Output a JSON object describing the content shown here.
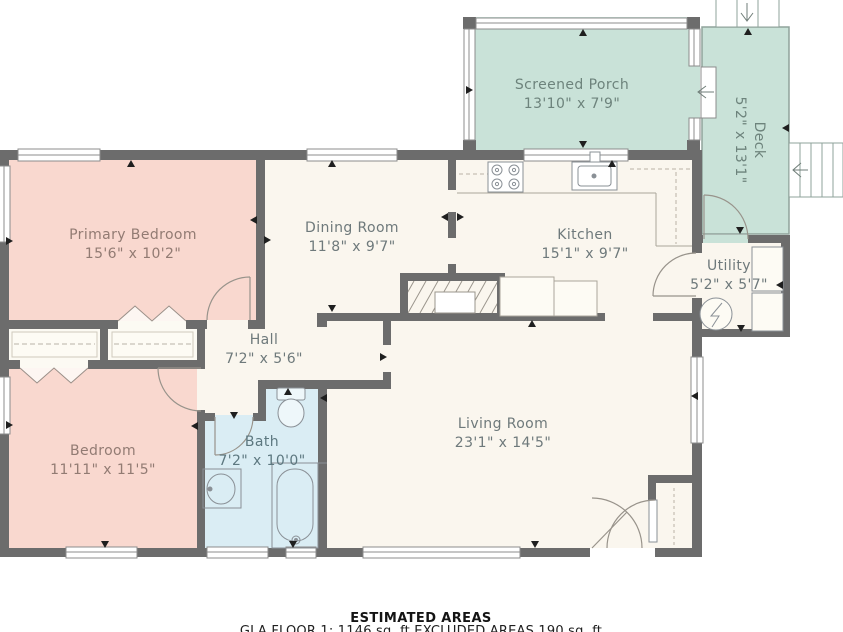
{
  "floorplan": {
    "rooms": {
      "screened_porch": {
        "name": "Screened Porch",
        "dims": "13'10\" x 7'9\""
      },
      "deck": {
        "name": "Deck",
        "dims": "5'2\" x 13'1\""
      },
      "primary_bedroom": {
        "name": "Primary Bedroom",
        "dims": "15'6\" x 10'2\""
      },
      "dining_room": {
        "name": "Dining Room",
        "dims": "11'8\" x 9'7\""
      },
      "kitchen": {
        "name": "Kitchen",
        "dims": "15'1\" x 9'7\""
      },
      "utility": {
        "name": "Utility",
        "dims": "5'2\" x 5'7\""
      },
      "hall": {
        "name": "Hall",
        "dims": "7'2\" x 5'6\""
      },
      "bedroom": {
        "name": "Bedroom",
        "dims": "11'11\" x 11'5\""
      },
      "bath": {
        "name": "Bath",
        "dims": "7'2\" x 10'0\""
      },
      "living_room": {
        "name": "Living Room",
        "dims": "23'1\" x 14'5\""
      }
    },
    "footer": {
      "title": "ESTIMATED AREAS",
      "detail": "GLA FLOOR 1: 1146 sq. ft EXCLUDED AREAS 190 sq. ft"
    },
    "colors": {
      "wall": "#6c6c6c",
      "floor": "#faf6ee",
      "bedroom_pink": "#f9d8cf",
      "porch_green": "#c9e2d8",
      "bath_blue": "#daedf4"
    }
  }
}
